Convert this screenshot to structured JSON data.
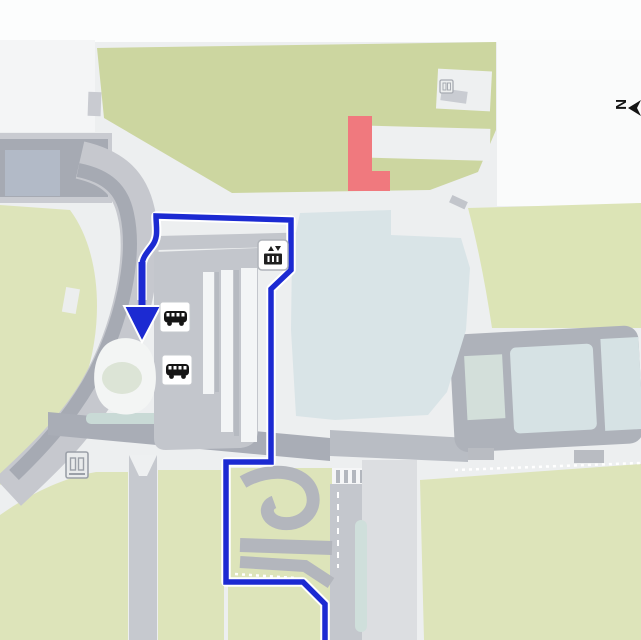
{
  "app": {
    "name": "airport-terminal-map-route-view"
  },
  "compass": {
    "label": "N"
  },
  "colors": {
    "white_bg": "#fbfcfc",
    "plaza": "#edeff0",
    "green_dark": "#ccd6a0",
    "green_light": "#dde4ba",
    "green_right": "#dce4b6",
    "road_gray": "#c6c8ce",
    "road_dark": "#a6aab3",
    "road_mid": "#b3b6bd",
    "loop_road": "#aeb2ba",
    "blue_gray_deck": "#b2bac7",
    "terminal_building": "#d9e4e7",
    "loop_cell": "#d6e2e4",
    "roundabout_center": "#dce4d6",
    "teal_strip": "#c9dad6",
    "route_blue": "#1c2ad2",
    "route_casing": "#ffffff",
    "highlight_red": "#f0797e",
    "icon_ink": "#1a1a1a"
  },
  "route": {
    "start": "bottom-edge-exit",
    "end": "bus-stop-arrow",
    "segments": "bottom edge up, left jog, north along terminal, around building top, west, down to bus bay arrow"
  },
  "markers": {
    "elevator": {
      "label": "elevator"
    },
    "bus_stop_1": {
      "label": "bus-stop"
    },
    "bus_stop_2": {
      "label": "bus-stop"
    },
    "facility_left": {
      "label": "elevator-facility"
    },
    "facility_top": {
      "label": "small-facility"
    }
  },
  "highlight": {
    "label": "highlighted-building"
  }
}
